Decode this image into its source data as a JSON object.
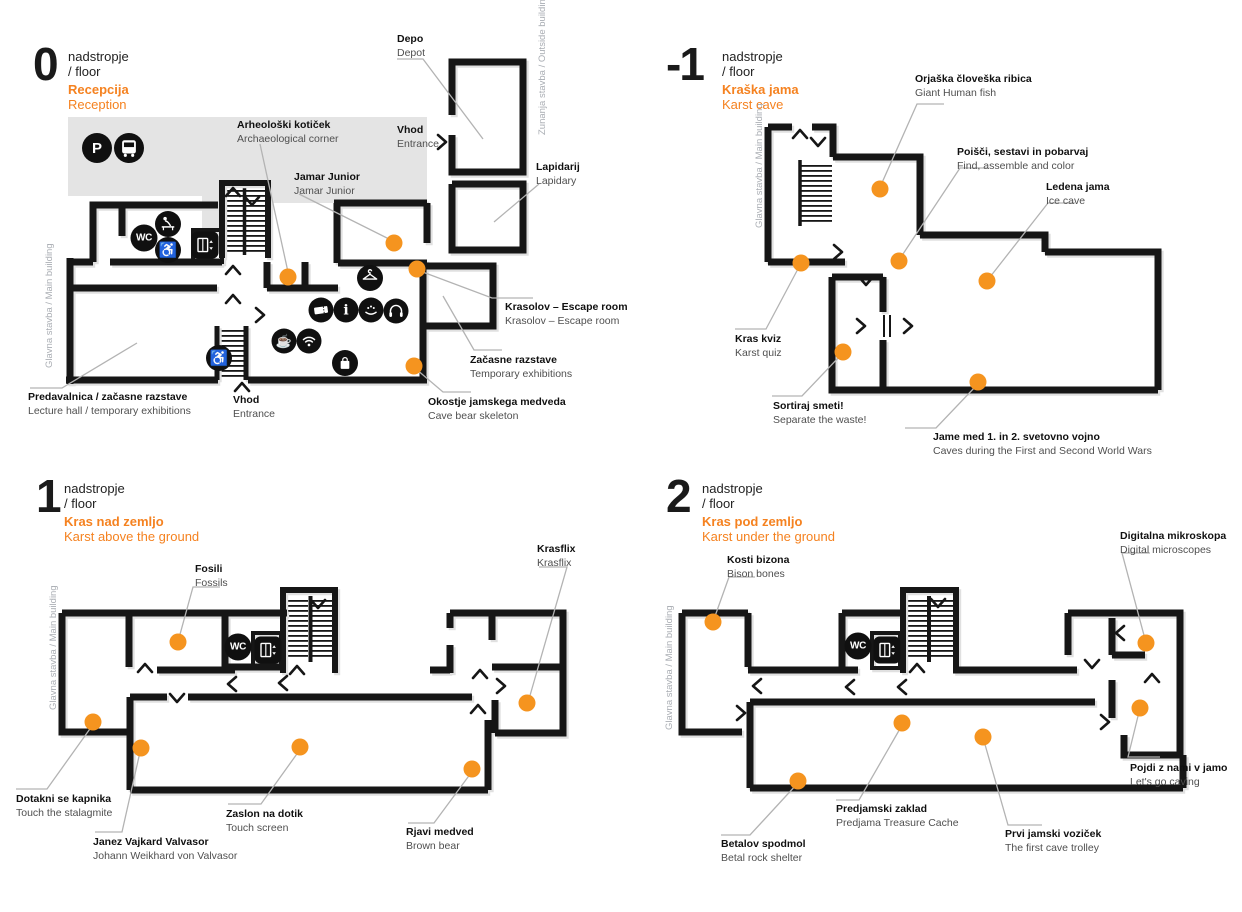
{
  "colors": {
    "wall": "#161616",
    "wall_shadow": "#e0e0e0",
    "background_gray": "#e4e4e4",
    "accent": "#f58220",
    "dot": "#f5941f",
    "label_en_gray": "#4f4f4f",
    "leader_gray": "#b3b3b3"
  },
  "icons": {
    "parking_glyph": "P",
    "wc_glyph": "WC",
    "info_glyph": "i",
    "cafe_glyph": "☕",
    "wheelchair_glyph": "♿"
  },
  "floors": [
    {
      "number": "0",
      "level_line1": "nadstropje",
      "level_line2": "/ floor",
      "title_sl": "Recepcija",
      "title_en": "Reception",
      "side_label": "Glavna stavba / Main building",
      "outside_label": "Zunanja stavba / Outside building",
      "labels": [
        {
          "sl": "Depo",
          "en": "Depot"
        },
        {
          "sl": "Vhod",
          "en": "Entrance"
        },
        {
          "sl": "Lapidarij",
          "en": "Lapidary"
        },
        {
          "sl": "Arheološki kotiček",
          "en": "Archaeological corner"
        },
        {
          "sl": "Jamar Junior",
          "en": "Jamar Junior"
        },
        {
          "sl": "Krasolov – Escape room",
          "en": "Krasolov – Escape room"
        },
        {
          "sl": "Začasne razstave",
          "en": "Temporary exhibitions"
        },
        {
          "sl": "Okostje jamskega medveda",
          "en": "Cave bear skeleton"
        },
        {
          "sl": "Predavalnica / začasne razstave",
          "en": "Lecture hall / temporary exhibitions"
        },
        {
          "sl": "Vhod",
          "en": "Entrance"
        }
      ]
    },
    {
      "number": "-1",
      "level_line1": "nadstropje",
      "level_line2": "/ floor",
      "title_sl": "Kraška jama",
      "title_en": "Karst cave",
      "side_label": "Glavna stavba / Main building",
      "labels": [
        {
          "sl": "Orjaška človeška ribica",
          "en": "Giant Human fish"
        },
        {
          "sl": "Poišči, sestavi in pobarvaj",
          "en": "Find, assemble and color"
        },
        {
          "sl": "Ledena jama",
          "en": "Ice cave"
        },
        {
          "sl": "Kras kviz",
          "en": "Karst quiz"
        },
        {
          "sl": "Sortiraj smeti!",
          "en": "Separate the waste!"
        },
        {
          "sl": "Jame med 1. in 2. svetovno vojno",
          "en": "Caves during the First and Second World Wars"
        }
      ]
    },
    {
      "number": "1",
      "level_line1": "nadstropje",
      "level_line2": "/ floor",
      "title_sl": "Kras nad zemljo",
      "title_en": "Karst above the ground",
      "side_label": "Glavna stavba / Main building",
      "labels": [
        {
          "sl": "Fosili",
          "en": "Fossils"
        },
        {
          "sl": "Krasflix",
          "en": "Krasflix"
        },
        {
          "sl": "Dotakni se kapnika",
          "en": "Touch the stalagmite"
        },
        {
          "sl": "Janez Vajkard Valvasor",
          "en": "Johann Weikhard von Valvasor"
        },
        {
          "sl": "Zaslon na dotik",
          "en": "Touch screen"
        },
        {
          "sl": "Rjavi medved",
          "en": "Brown bear"
        }
      ]
    },
    {
      "number": "2",
      "level_line1": "nadstropje",
      "level_line2": "/ floor",
      "title_sl": "Kras pod zemljo",
      "title_en": "Karst under the ground",
      "side_label": "Glavna stavba / Main building",
      "labels": [
        {
          "sl": "Kosti bizona",
          "en": "Bison bones"
        },
        {
          "sl": "Digitalna mikroskopa",
          "en": "Digital microscopes"
        },
        {
          "sl": "Betalov spodmol",
          "en": "Betal rock shelter"
        },
        {
          "sl": "Predjamski zaklad",
          "en": "Predjama Treasure Cache"
        },
        {
          "sl": "Prvi jamski voziček",
          "en": "The first cave trolley"
        },
        {
          "sl": "Pojdi z nami v jamo",
          "en": "Let's go caving"
        }
      ]
    }
  ]
}
